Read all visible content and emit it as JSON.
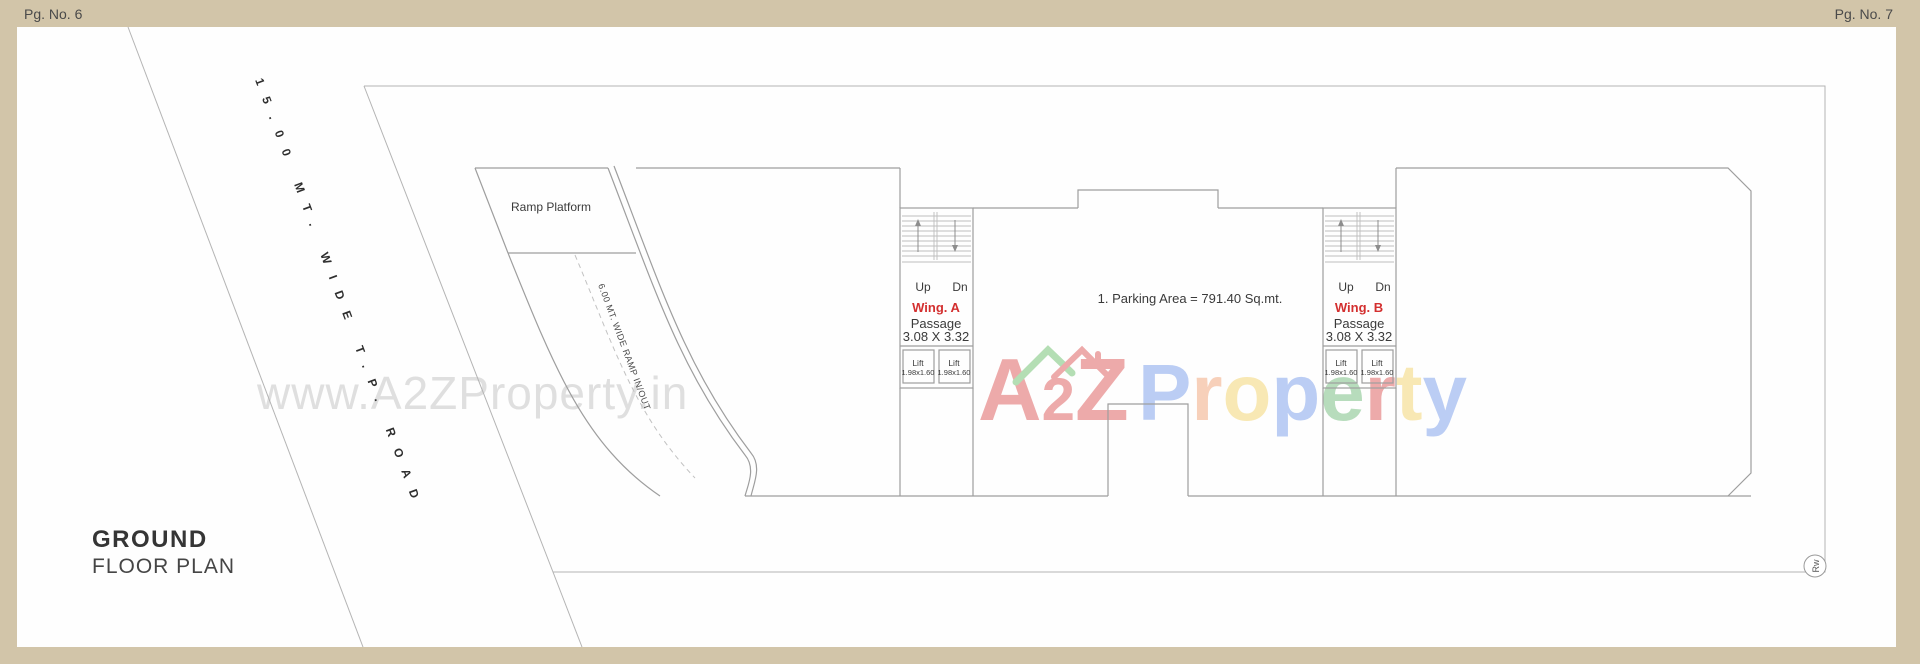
{
  "page": {
    "left_page_no": "Pg. No. 6",
    "right_page_no": "Pg. No. 7"
  },
  "plan_title": {
    "line1": "GROUND",
    "line2": "FLOOR PLAN"
  },
  "labels": {
    "road": "15.00 MT. WIDE T.P. ROAD",
    "ramp_platform": "Ramp Platform",
    "ramp": "6.00 MT. WIDE RAMP IN/OUT",
    "parking_note": "1. Parking Area = 791.40 Sq.mt.",
    "edge_marker": "Rw"
  },
  "wing_a": {
    "up": "Up",
    "dn": "Dn",
    "name": "Wing. A",
    "passage": "Passage",
    "passage_size": "3.08 X 3.32",
    "lifts": [
      {
        "label": "Lift",
        "size": "1.98x1.60"
      },
      {
        "label": "Lift",
        "size": "1.98x1.60"
      }
    ]
  },
  "wing_b": {
    "up": "Up",
    "dn": "Dn",
    "name": "Wing. B",
    "passage": "Passage",
    "passage_size": "3.08 X 3.32",
    "lifts": [
      {
        "label": "Lift",
        "size": "1.98x1.60"
      },
      {
        "label": "Lift",
        "size": "1.98x1.60"
      }
    ]
  },
  "watermark": {
    "url_text": "www.A2ZProperty.in",
    "logo_a": "A",
    "logo_2": "2",
    "logo_z": "Z",
    "property_letters": [
      "P",
      "r",
      "o",
      "p",
      "e",
      "r",
      "t",
      "y"
    ]
  },
  "colors": {
    "paper_border": "#d2c5a9",
    "canvas": "#ffffff",
    "line_gray": "#b4b4b4",
    "text_dark": "#3a3a3a",
    "wing_red": "#d32f2f",
    "watermark_gray": "#cfcfcf",
    "logo_red": "#d94545",
    "logo_blue": "#6b93e8",
    "logo_orange": "#ef9a6a",
    "logo_yellow": "#f2cf5b",
    "logo_green": "#63b56d"
  }
}
